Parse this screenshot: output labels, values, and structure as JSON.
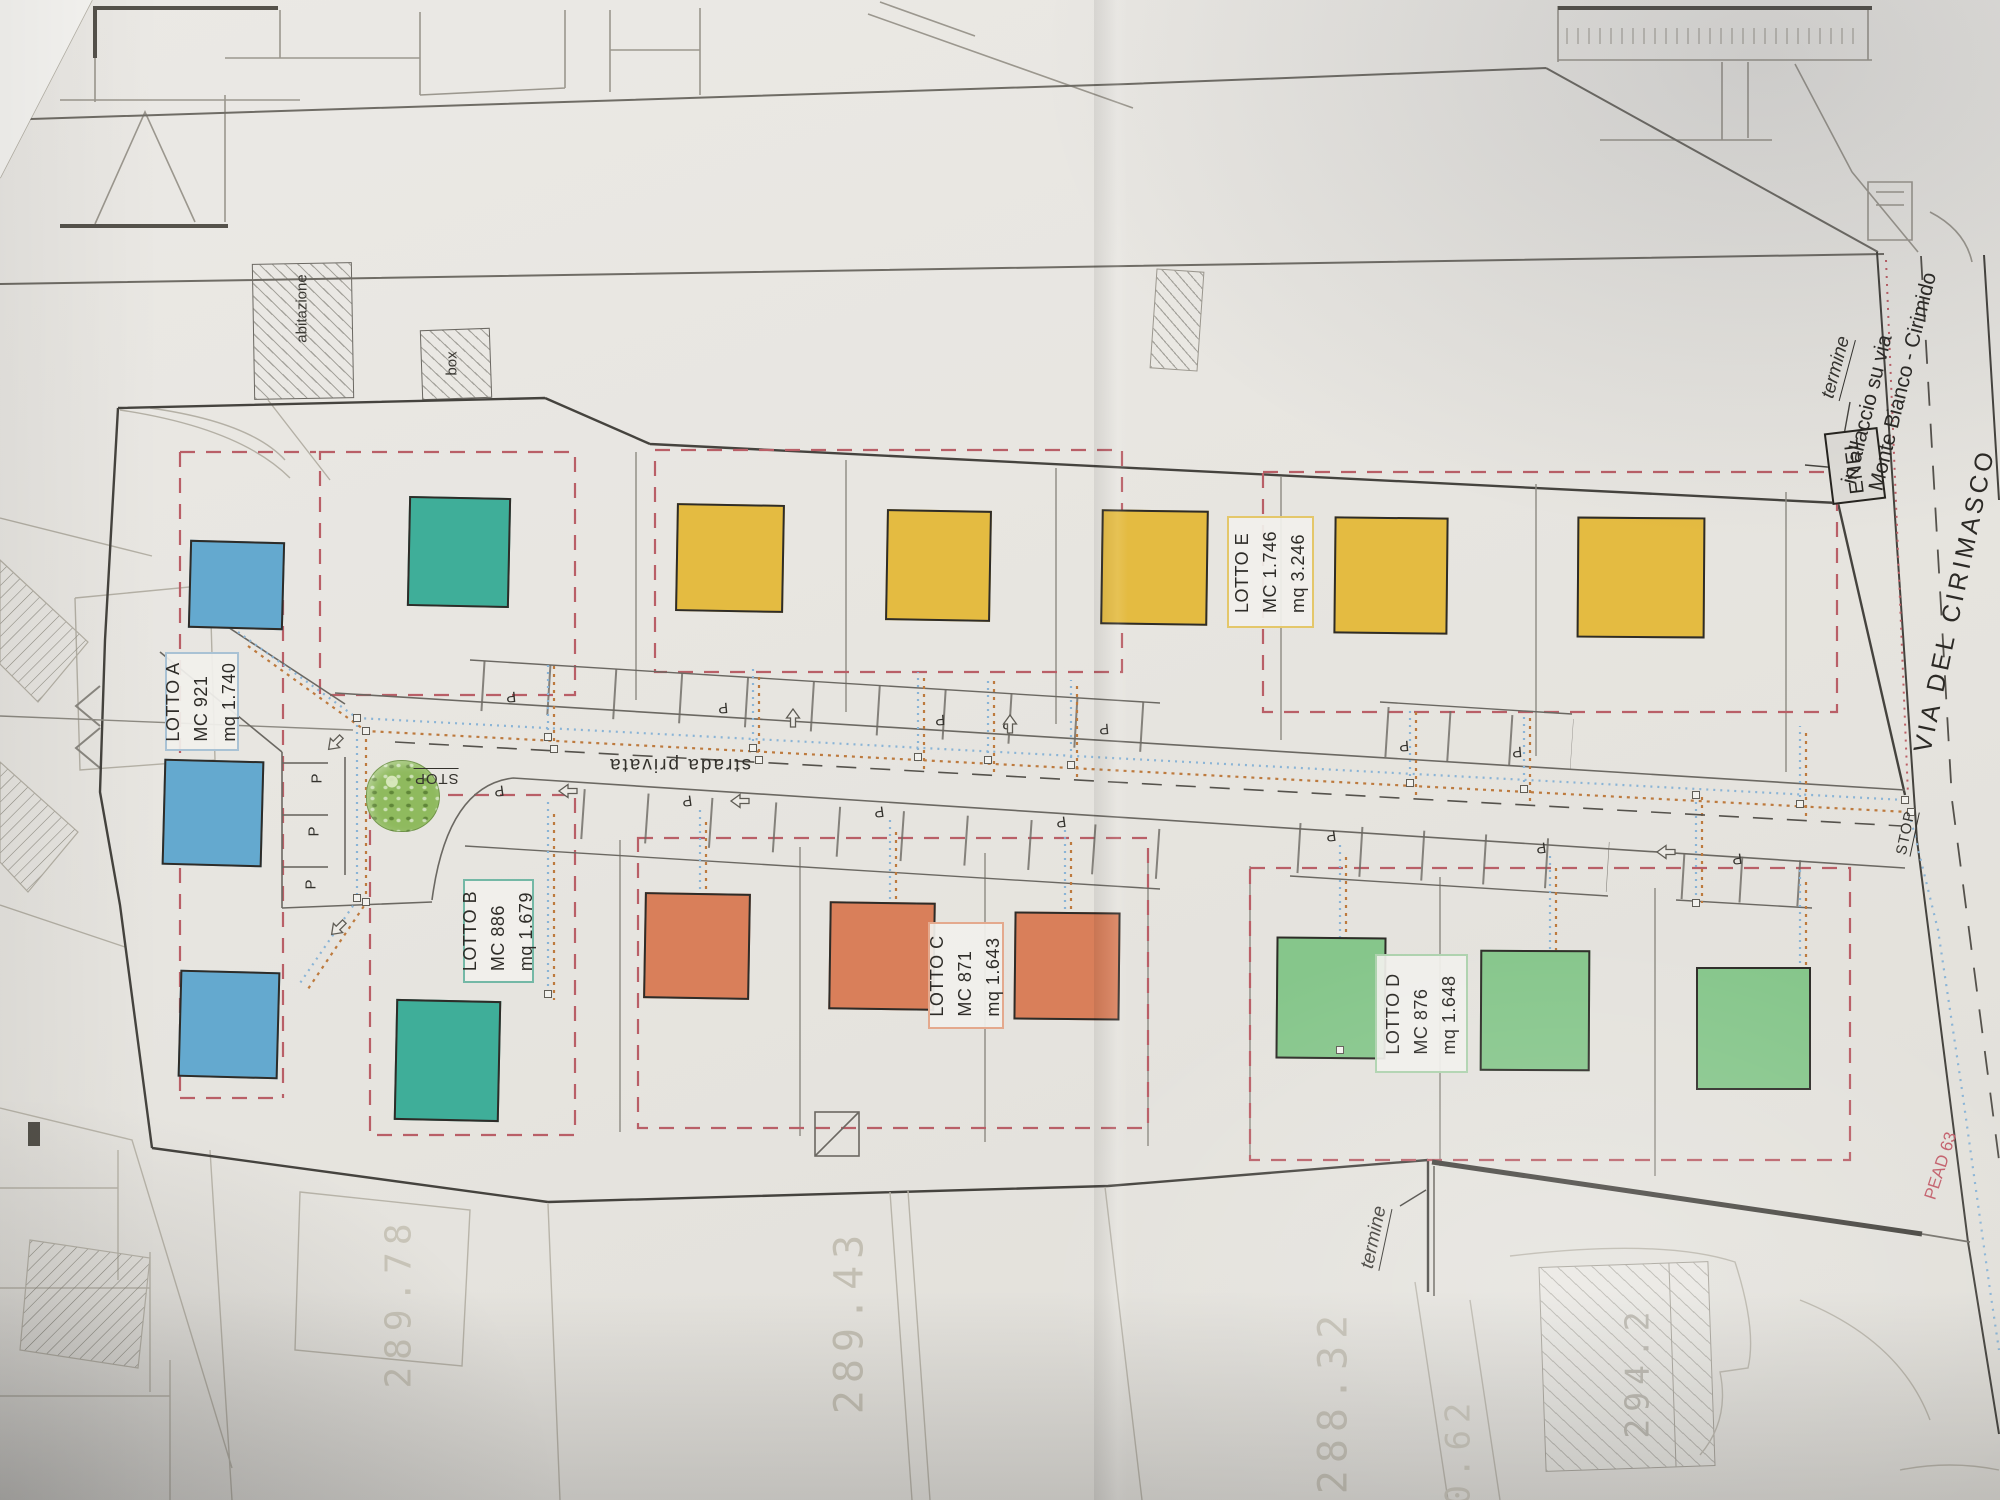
{
  "labels": {
    "abitazione": "abitazione",
    "box": "box",
    "strada_privata": "strada privata",
    "stop_left": "STOP",
    "stop_right": "STOP",
    "termine_top": "termine",
    "termine_bottom": "termine",
    "enel": "ENEL",
    "via_cirimasco": "VIA  DEL  CIRIMASCO",
    "allaccio_line1": "in allaccio su via",
    "allaccio_line2": "Monte Bianco - Cirimido",
    "pead": "PEAD 63",
    "parking_letter": "P"
  },
  "lot_labels": [
    {
      "x": 165,
      "y": 652,
      "w": 74,
      "h": 99,
      "border": "#a9c2d4",
      "title": "LOTTO A",
      "mc": "MC 921",
      "mq": "mq 1.740"
    },
    {
      "x": 463,
      "y": 879,
      "w": 71,
      "h": 104,
      "border": "#74b8a6",
      "title": "LOTTO B",
      "mc": "MC 886",
      "mq": "mq 1.679"
    },
    {
      "x": 928,
      "y": 922,
      "w": 76,
      "h": 107,
      "border": "#e4a98d",
      "title": "LOTTO C",
      "mc": "MC 871",
      "mq": "mq 1.643"
    },
    {
      "x": 1375,
      "y": 954,
      "w": 93,
      "h": 119,
      "border": "#aed2ae",
      "title": "LOTTO D",
      "mc": "MC 876",
      "mq": "mq 1.648"
    },
    {
      "x": 1227,
      "y": 516,
      "w": 87,
      "h": 112,
      "border": "#e4c76a",
      "title": "LOTTO E",
      "mc": "MC 1.746",
      "mq": "mq 3.246"
    }
  ],
  "squares": [
    {
      "x": 189,
      "y": 541,
      "w": 95,
      "h": 88,
      "rot": 1.5,
      "color": "#64a9cf"
    },
    {
      "x": 163,
      "y": 760,
      "w": 100,
      "h": 106,
      "rot": 1.5,
      "color": "#64a9cf"
    },
    {
      "x": 179,
      "y": 971,
      "w": 100,
      "h": 107,
      "rot": 1.5,
      "color": "#64a9cf"
    },
    {
      "x": 408,
      "y": 497,
      "w": 102,
      "h": 110,
      "rot": 1.2,
      "color": "#3fae99"
    },
    {
      "x": 395,
      "y": 1000,
      "w": 105,
      "h": 121,
      "rot": 1.2,
      "color": "#3fae99"
    },
    {
      "x": 676,
      "y": 504,
      "w": 108,
      "h": 108,
      "rot": 1,
      "color": "#e4bb41"
    },
    {
      "x": 886,
      "y": 510,
      "w": 105,
      "h": 111,
      "rot": 1,
      "color": "#e4bb41"
    },
    {
      "x": 1101,
      "y": 510,
      "w": 107,
      "h": 115,
      "rot": 0.8,
      "color": "#e4bb41"
    },
    {
      "x": 1334,
      "y": 517,
      "w": 114,
      "h": 117,
      "rot": 0.6,
      "color": "#e4bb41"
    },
    {
      "x": 1577,
      "y": 517,
      "w": 128,
      "h": 121,
      "rot": 0.4,
      "color": "#e4bb41"
    },
    {
      "x": 644,
      "y": 893,
      "w": 106,
      "h": 106,
      "rot": 1,
      "color": "#d97f5a"
    },
    {
      "x": 829,
      "y": 902,
      "w": 106,
      "h": 108,
      "rot": 0.8,
      "color": "#d97f5a"
    },
    {
      "x": 1014,
      "y": 912,
      "w": 106,
      "h": 108,
      "rot": 0.6,
      "color": "#d97f5a"
    },
    {
      "x": 1276,
      "y": 937,
      "w": 110,
      "h": 122,
      "rot": 0.5,
      "color": "#86c68b"
    },
    {
      "x": 1480,
      "y": 950,
      "w": 110,
      "h": 121,
      "rot": 0.3,
      "color": "#86c68b"
    },
    {
      "x": 1696,
      "y": 967,
      "w": 115,
      "h": 123,
      "rot": 0,
      "color": "#86c68b"
    }
  ],
  "parking": [
    {
      "t": "P",
      "x": 312,
      "y": 770,
      "rot": -90
    },
    {
      "t": "P",
      "x": 309,
      "y": 823,
      "rot": -90
    },
    {
      "t": "P",
      "x": 306,
      "y": 876,
      "rot": -90
    },
    {
      "t": "P",
      "x": 506,
      "y": 688,
      "rot": 175
    },
    {
      "t": "P",
      "x": 718,
      "y": 699,
      "rot": 175
    },
    {
      "t": "P",
      "x": 935,
      "y": 711,
      "rot": 175
    },
    {
      "t": "P",
      "x": 1002,
      "y": 715,
      "rot": 175
    },
    {
      "t": "P",
      "x": 1099,
      "y": 720,
      "rot": 175
    },
    {
      "t": "P",
      "x": 1399,
      "y": 737,
      "rot": 175
    },
    {
      "t": "P",
      "x": 1512,
      "y": 743,
      "rot": 175
    },
    {
      "t": "P",
      "x": 494,
      "y": 782,
      "rot": 172
    },
    {
      "t": "P",
      "x": 682,
      "y": 792,
      "rot": 172
    },
    {
      "t": "P",
      "x": 874,
      "y": 803,
      "rot": 172
    },
    {
      "t": "P",
      "x": 1056,
      "y": 813,
      "rot": 172
    },
    {
      "t": "P",
      "x": 1326,
      "y": 827,
      "rot": 172
    },
    {
      "t": "P",
      "x": 1536,
      "y": 839,
      "rot": 172
    },
    {
      "t": "P",
      "x": 1732,
      "y": 850,
      "rot": 172
    }
  ],
  "arrows": [
    {
      "x": 324,
      "y": 735,
      "rot": 135
    },
    {
      "x": 327,
      "y": 920,
      "rot": 135
    },
    {
      "x": 557,
      "y": 783,
      "rot": 180
    },
    {
      "x": 729,
      "y": 793,
      "rot": 180
    },
    {
      "x": 1655,
      "y": 844,
      "rot": 180
    },
    {
      "x": 782,
      "y": 710,
      "rot": -90
    },
    {
      "x": 999,
      "y": 716,
      "rot": -90
    }
  ],
  "nodes": [
    {
      "x": 353,
      "y": 714
    },
    {
      "x": 362,
      "y": 727
    },
    {
      "x": 544,
      "y": 733
    },
    {
      "x": 550,
      "y": 745
    },
    {
      "x": 749,
      "y": 744
    },
    {
      "x": 755,
      "y": 756
    },
    {
      "x": 914,
      "y": 753
    },
    {
      "x": 984,
      "y": 756
    },
    {
      "x": 1067,
      "y": 761
    },
    {
      "x": 1406,
      "y": 779
    },
    {
      "x": 1520,
      "y": 785
    },
    {
      "x": 1796,
      "y": 800
    },
    {
      "x": 1901,
      "y": 796
    },
    {
      "x": 1907,
      "y": 808
    },
    {
      "x": 353,
      "y": 894
    },
    {
      "x": 362,
      "y": 898
    },
    {
      "x": 1692,
      "y": 791
    },
    {
      "x": 1692,
      "y": 899
    },
    {
      "x": 544,
      "y": 990
    },
    {
      "x": 1336,
      "y": 1046
    }
  ],
  "elevations": [
    {
      "value": "289.78",
      "x": 313,
      "y": 1282,
      "rot": -90,
      "size": 36,
      "fg": "#c9c5b9"
    },
    {
      "value": "289.43",
      "x": 756,
      "y": 1298,
      "rot": -90,
      "size": 40,
      "fg": "#c3bfb3"
    },
    {
      "value": "288.32",
      "x": 1240,
      "y": 1378,
      "rot": -90,
      "size": 40,
      "fg": "#c3bfb3"
    },
    {
      "value": "290.62",
      "x": 1376,
      "y": 1458,
      "rot": -90,
      "size": 34,
      "fg": "#c9c5b9"
    },
    {
      "value": "294.2",
      "x": 1570,
      "y": 1352,
      "rot": -90,
      "size": 33,
      "fg": "#b5b2a8"
    }
  ],
  "palette": {
    "lot_boundary_red": "#b95f67",
    "utility_blue": "#8ab4d6",
    "utility_orange": "#bd7a3e",
    "paper": "#e8e6e1",
    "ink_dark": "#45433e"
  }
}
